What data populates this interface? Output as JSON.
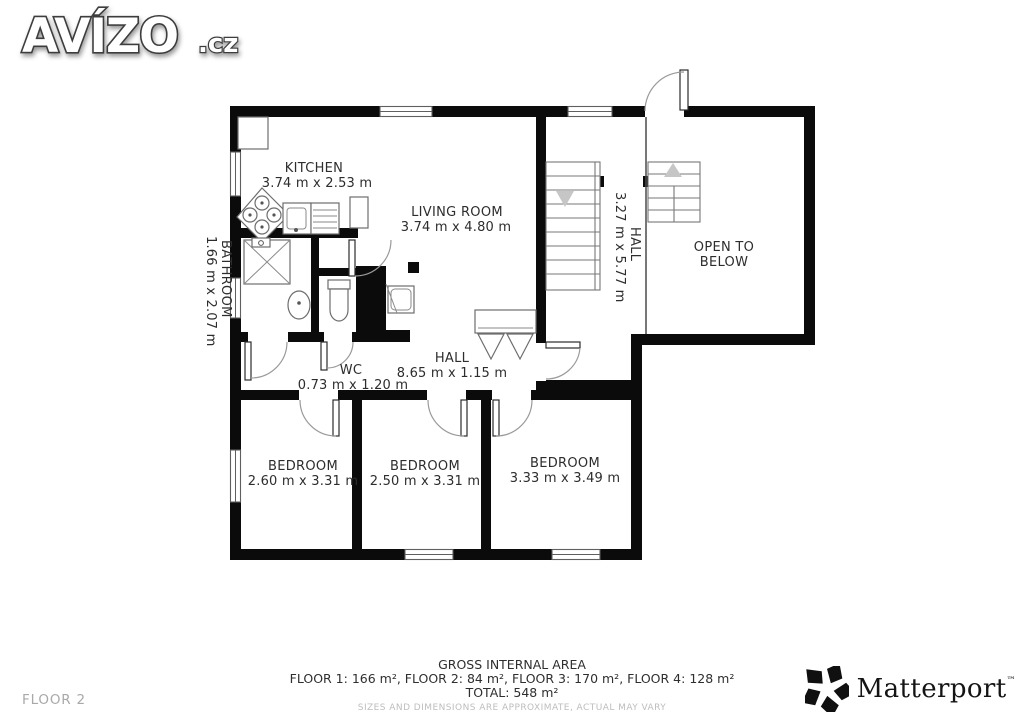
{
  "brand": {
    "name": "AVÍZO",
    "tld": ".cz"
  },
  "floor_label": "FLOOR 2",
  "rooms": {
    "kitchen": {
      "name": "KITCHEN",
      "dims": "3.74 m x 2.53 m"
    },
    "living": {
      "name": "LIVING ROOM",
      "dims": "3.74 m x 4.80 m"
    },
    "bathroom": {
      "name": "BATHROOM",
      "dims": "1.66 m x 2.07 m"
    },
    "wc": {
      "name": "WC",
      "dims": "0.73 m x 1.20 m"
    },
    "hall": {
      "name": "HALL",
      "dims": "8.65 m x 1.15 m"
    },
    "hall2": {
      "name": "HALL",
      "dims": "3.27 m x 5.77 m"
    },
    "open_below": {
      "line1": "OPEN TO",
      "line2": "BELOW"
    },
    "bedroom1": {
      "name": "BEDROOM",
      "dims": "2.60 m x 3.31 m"
    },
    "bedroom2": {
      "name": "BEDROOM",
      "dims": "2.50 m x 3.31 m"
    },
    "bedroom3": {
      "name": "BEDROOM",
      "dims": "3.33 m x 3.49 m"
    }
  },
  "footer": {
    "title": "GROSS INTERNAL AREA",
    "floors": "FLOOR 1: 166 m², FLOOR 2: 84 m², FLOOR 3: 170 m², FLOOR 4: 128 m²",
    "total": "TOTAL: 548 m²",
    "disclaimer": "SIZES AND DIMENSIONS ARE APPROXIMATE, ACTUAL MAY VARY"
  },
  "watermark": {
    "name": "Matterport",
    "tm": "™"
  },
  "colors": {
    "wall": "#0b0b0b",
    "label": "#2d2d2d",
    "muted": "#a9a9a9",
    "disclaimer": "#bdbdbd"
  }
}
